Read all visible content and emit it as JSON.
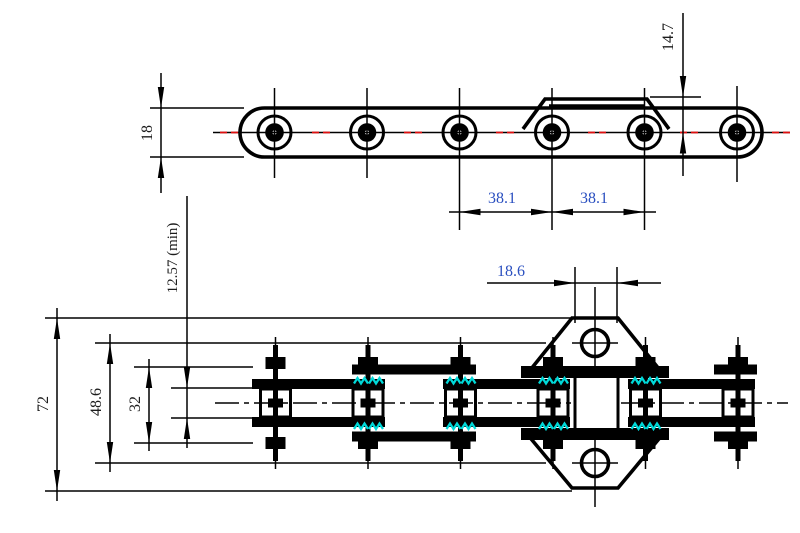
{
  "drawing": {
    "type": "engineering-dimension-drawing",
    "subject": "double pitch conveyor roller chain with bent attachment link",
    "views": [
      {
        "name": "side-elevation",
        "position": "top"
      },
      {
        "name": "plan-view",
        "position": "bottom"
      }
    ]
  },
  "labels": {
    "plate_height": "18",
    "attachment_tab_height": "14.7",
    "pitch_left": "38.1",
    "pitch_right": "38.1",
    "attachment_top_width": "18.6",
    "inner_width_min": "12.57 (min)",
    "overall_attachment_span": "72",
    "pin_overall_length": "48.6",
    "outer_plate_span": "32"
  },
  "colors": {
    "outline": "#000000",
    "dim_text_black": "#1c1c1c",
    "dim_text_blue": "#2b50c0",
    "centerline_red": "#e01010",
    "hatch_cyan": "#00d9d9",
    "background": "#ffffff"
  }
}
